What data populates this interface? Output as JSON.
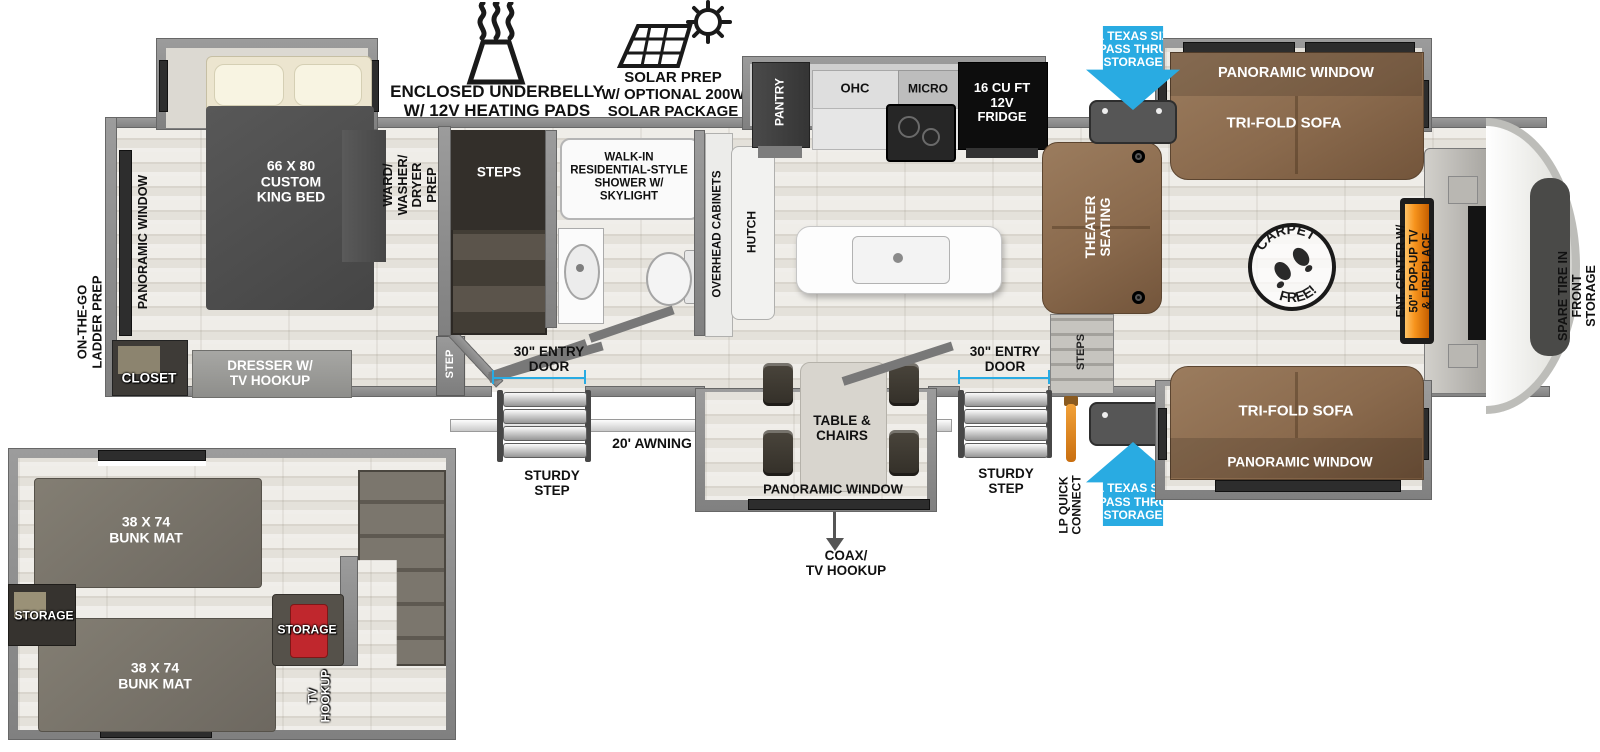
{
  "colors": {
    "accent_blue": "#29ABE2",
    "wall_gray": "#8A8A8A",
    "sofa_brown": "#8C6D52",
    "fireplace_orange": "#F7941D",
    "floor": "#E8E5E0",
    "storage_red": "#C0272D"
  },
  "callouts": {
    "underbelly": "ENCLOSED UNDERBELLY\nW/ 12V HEATING PADS",
    "solar": "SOLAR PREP\nW/ OPTIONAL 200W\nSOLAR PACKAGE"
  },
  "storage_arrows": {
    "front_top": "XL TEXAS SIZE\nPASS THRU\nSTORAGE",
    "front_bottom": "XL TEXAS SIZE\nPASS THRU\nSTORAGE"
  },
  "bedroom": {
    "bed": "66 X 80\nCUSTOM\nKING BED",
    "window": "PANORAMIC WINDOW",
    "ladder_prep": "ON-THE-GO\nLADDER PREP",
    "closet": "CLOSET",
    "dresser": "DRESSER W/\nTV HOOKUP",
    "wardrobe": "WARD/\nWASHER/\nDRYER\nPREP",
    "step": "STEP"
  },
  "bath": {
    "stairs": "STEPS",
    "shower": "WALK-IN\nRESIDENTIAL-STYLE\nSHOWER W/\nSKYLIGHT"
  },
  "kitchen": {
    "pantry": "PANTRY",
    "ohc": "OHC",
    "micro": "MICRO",
    "fridge": "16 CU FT\n12V\nFRIDGE",
    "overhead_cabinets": "OVERHEAD CABINETS",
    "hutch": "HUTCH"
  },
  "living": {
    "theater": "THEATER\nSEATING",
    "steps": "STEPS",
    "sofa_top_window": "PANORAMIC WINDOW",
    "sofa_top": "TRI-FOLD SOFA",
    "sofa_bottom": "TRI-FOLD SOFA",
    "sofa_bottom_window": "PANORAMIC WINDOW",
    "ent_center": "ENT. CENTER W/\n50\" POP-UP TV\n& FIREPLACE",
    "carpet_stamp_top": "CARPET",
    "carpet_stamp_bottom": "FREE!",
    "spare_tire": "SPARE TIRE IN FRONT\nSTORAGE COMPARTMENT"
  },
  "dinette": {
    "table": "TABLE &\nCHAIRS",
    "window": "PANORAMIC WINDOW",
    "coax": "COAX/\nTV HOOKUP"
  },
  "exterior": {
    "door1": "30\" ENTRY\nDOOR",
    "door2": "30\" ENTRY\nDOOR",
    "step1": "STURDY\nSTEP",
    "step2": "STURDY\nSTEP",
    "awning": "20' AWNING",
    "lp": "LP QUICK\nCONNECT"
  },
  "loft": {
    "bunk_top": "38 X 74\nBUNK MAT",
    "bunk_bottom": "38 X 74\nBUNK MAT",
    "storage_left": "STORAGE",
    "storage_right": "STORAGE",
    "tv_hookup": "TV\nHOOKUP"
  }
}
